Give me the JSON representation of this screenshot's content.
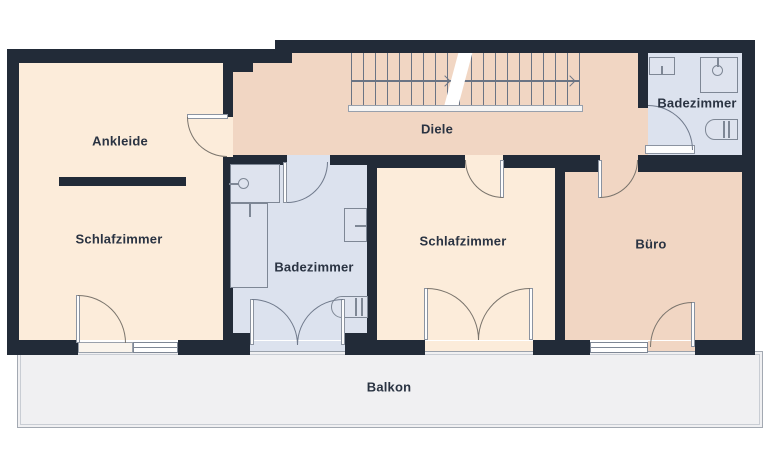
{
  "plan_type": "floorplan",
  "rooms": [
    {
      "name": "ankleide",
      "label": "Ankleide"
    },
    {
      "name": "schlafzimmer-left",
      "label": "Schlafzimmer"
    },
    {
      "name": "badezimmer-middle",
      "label": "Badezimmer"
    },
    {
      "name": "diele",
      "label": "Diele"
    },
    {
      "name": "schlafzimmer-middle",
      "label": "Schlafzimmer"
    },
    {
      "name": "buero",
      "label": "Büro"
    },
    {
      "name": "badezimmer-right",
      "label": "Badezimmer"
    },
    {
      "name": "balkon",
      "label": "Balkon"
    }
  ],
  "fixtures": [
    "staircase-with-direction-arrow",
    "wardrobe-bar",
    "shower-left-bath",
    "bathtub-left-bath",
    "washbasin-left-bath",
    "toilet-left-bath",
    "washbasin-right-bath",
    "shower-right-bath",
    "toilet-right-bath"
  ],
  "doors": [
    "ankleide-door",
    "left-bath-hall-door",
    "left-bath-balcony-french-door",
    "middle-bedroom-hall-door",
    "middle-bedroom-balcony-french-door",
    "buero-hall-door",
    "buero-balcony-door",
    "right-bath-door",
    "left-bedroom-balcony-door"
  ],
  "colors": {
    "wall": "#222b38",
    "room_cream": "#fcecda",
    "room_peach": "#f1d6c3",
    "room_bath": "#dce2ee",
    "fixture_fill": "#dee3ee",
    "balcony": "#f0f0f2",
    "label_text": "#2a3342",
    "door_arc": "#7a746c"
  }
}
